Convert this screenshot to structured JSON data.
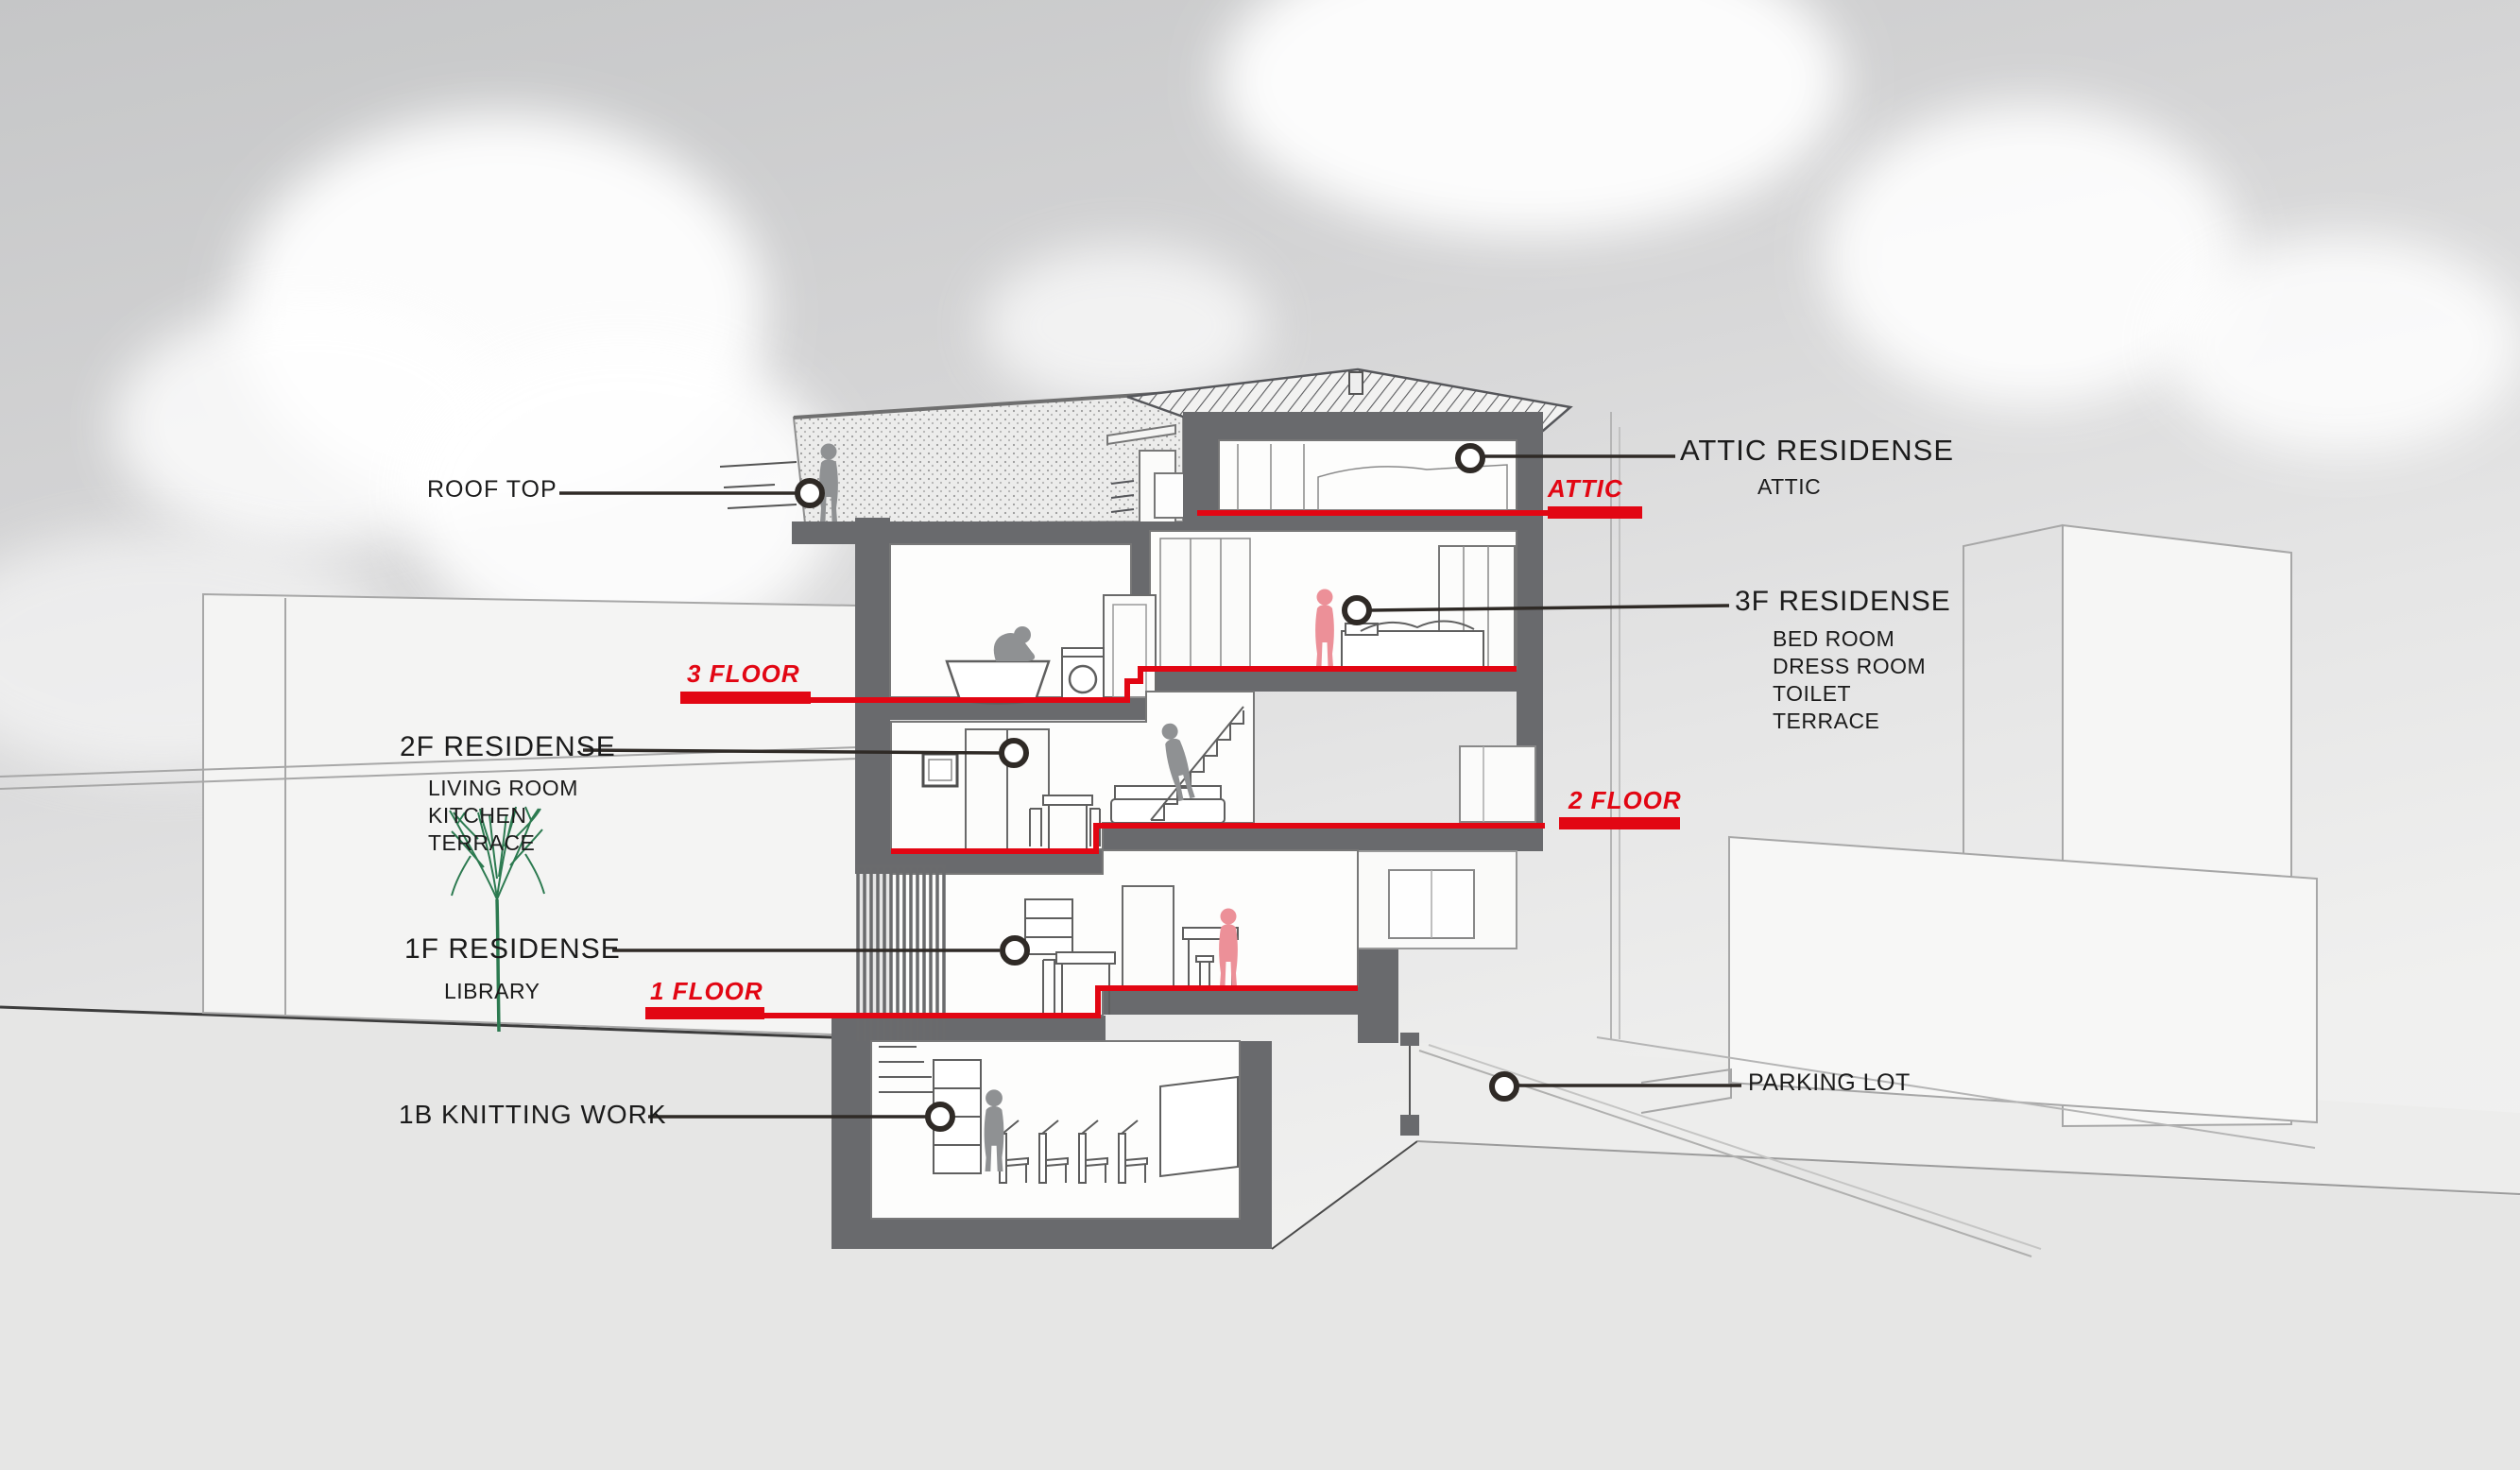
{
  "title": "Building Section Diagram",
  "colors": {
    "red": "#e20613",
    "wall": "#696a6d",
    "label_text": "#1b1b1b",
    "figure_gray": "#8f9193",
    "figure_red": "#ec9098",
    "tree_green": "#2c7a50"
  },
  "labels": {
    "roof_top": "ROOF TOP",
    "attic_heading": "ATTIC RESIDENSE",
    "attic_room": "ATTIC",
    "attic_level": "ATTIC",
    "level_3": "3 FLOOR",
    "f3_heading": "3F RESIDENSE",
    "f3_rooms": [
      "BED ROOM",
      "DRESS ROOM",
      "TOILET",
      "TERRACE"
    ],
    "f2_heading": "2F RESIDENSE",
    "f2_rooms": [
      "LIVING ROOM",
      "KITCHEN",
      "TERRACE"
    ],
    "level_2": "2 FLOOR",
    "f1_heading": "1F RESIDENSE",
    "f1_rooms": [
      "LIBRARY"
    ],
    "level_1": "1 FLOOR",
    "b1_heading": "1B KNITTING WORK",
    "parking": "PARKING LOT"
  }
}
